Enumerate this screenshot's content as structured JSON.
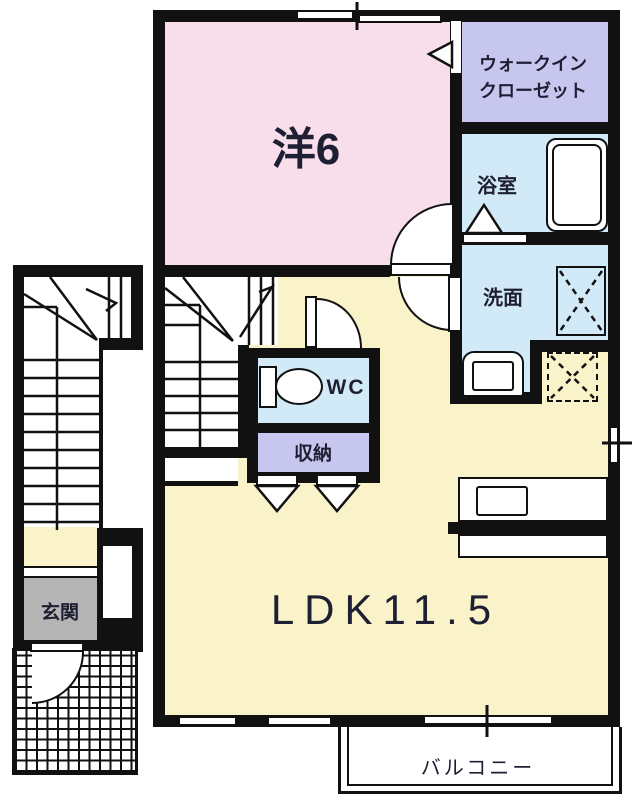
{
  "rooms": {
    "western": {
      "label": "洋6"
    },
    "walk_in_closet": {
      "label_line1": "ウォークイン",
      "label_line2": "クローゼット"
    },
    "bathroom": {
      "label": "浴室"
    },
    "washroom": {
      "label": "洗面"
    },
    "wc": {
      "label": "WC"
    },
    "storage": {
      "label": "収納"
    },
    "ldk": {
      "label": "LDK11.5"
    },
    "entrance": {
      "label": "玄関"
    },
    "balcony": {
      "label": "バルコニー"
    }
  },
  "colors": {
    "wall": "#111111",
    "western_room": "#f8deea",
    "closet_and_storage": "#c6c6ee",
    "water_rooms": "#d2e9f7",
    "ldk_and_hall": "#faf3ca",
    "entrance_floor": "#b5b5b5",
    "background": "#ffffff",
    "label_ink": "#1f1f33"
  },
  "icons": {
    "bathtub": "bathtub",
    "toilet": "toilet",
    "washbasin": "washbasin",
    "washing_machine_pan": "washing-machine-pan",
    "refrigerator_space": "refrigerator-space",
    "kitchen_counter": "kitchen-counter-with-sink",
    "exterior_stairs": "exterior-stairs",
    "interior_stairs": "interior-stairs",
    "porch_tiles": "entrance-porch-tiles",
    "door_arcs": "hinged-door-swing",
    "folding_doors": "folding-door-triangle",
    "windows": "window-openings"
  }
}
